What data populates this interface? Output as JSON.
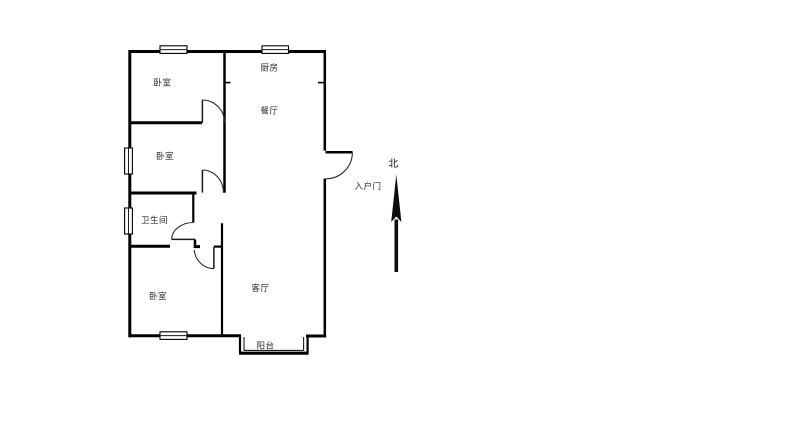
{
  "floorplan": {
    "background_color": "#ffffff",
    "wall_color": "#000000",
    "text_color": "#2a2a2a",
    "rooms": {
      "bedroom_top": {
        "label": "卧室"
      },
      "kitchen": {
        "label": "厨房"
      },
      "dining": {
        "label": "餐厅"
      },
      "bedroom_middle": {
        "label": "卧室"
      },
      "bathroom": {
        "label": "卫生间"
      },
      "bedroom_bottom": {
        "label": "卧室"
      },
      "living": {
        "label": "客厅"
      },
      "balcony": {
        "label": "阳台"
      }
    },
    "annotations": {
      "entrance_door": {
        "label": "入户门"
      },
      "compass_north": {
        "label": "北"
      }
    }
  }
}
